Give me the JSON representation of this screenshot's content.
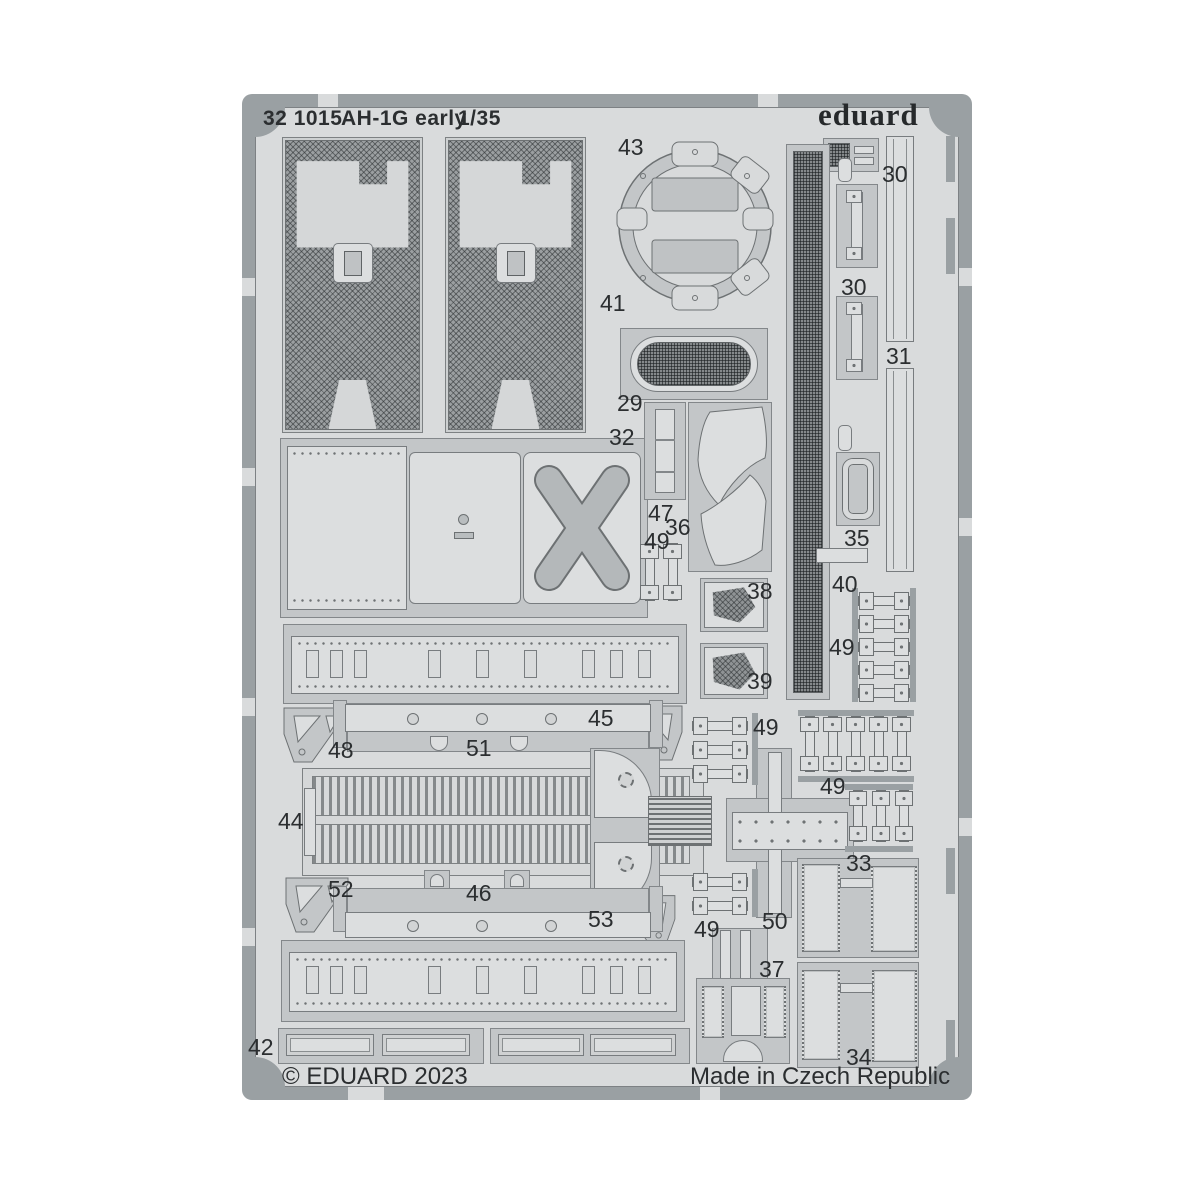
{
  "sheet": {
    "catalog_number": "32 1015",
    "kit_name": "AH-1G early",
    "scale": "1/35",
    "brand_logo": "eduard",
    "copyright": "© EDUARD 2023",
    "made_in": "Made in Czech Republic"
  },
  "colors": {
    "page_bg": "#ffffff",
    "sheet_bg": "#d9dbdc",
    "frame": "#9aa0a3",
    "part_fill": "#c3c6c8",
    "plate_fill": "#dcdedf",
    "mesh_dark": "#6f7376",
    "text": "#2b2e30"
  },
  "part_labels": [
    {
      "label": "43"
    },
    {
      "label": "30"
    },
    {
      "label": "30"
    },
    {
      "label": "41"
    },
    {
      "label": "31"
    },
    {
      "label": "29"
    },
    {
      "label": "32"
    },
    {
      "label": "47"
    },
    {
      "label": "36"
    },
    {
      "label": "49"
    },
    {
      "label": "35"
    },
    {
      "label": "40"
    },
    {
      "label": "38"
    },
    {
      "label": "49"
    },
    {
      "label": "39"
    },
    {
      "label": "45"
    },
    {
      "label": "48"
    },
    {
      "label": "51"
    },
    {
      "label": "49"
    },
    {
      "label": "44"
    },
    {
      "label": "49"
    },
    {
      "label": "33"
    },
    {
      "label": "52"
    },
    {
      "label": "46"
    },
    {
      "label": "53"
    },
    {
      "label": "49"
    },
    {
      "label": "50"
    },
    {
      "label": "37"
    },
    {
      "label": "42"
    },
    {
      "label": "34"
    }
  ]
}
